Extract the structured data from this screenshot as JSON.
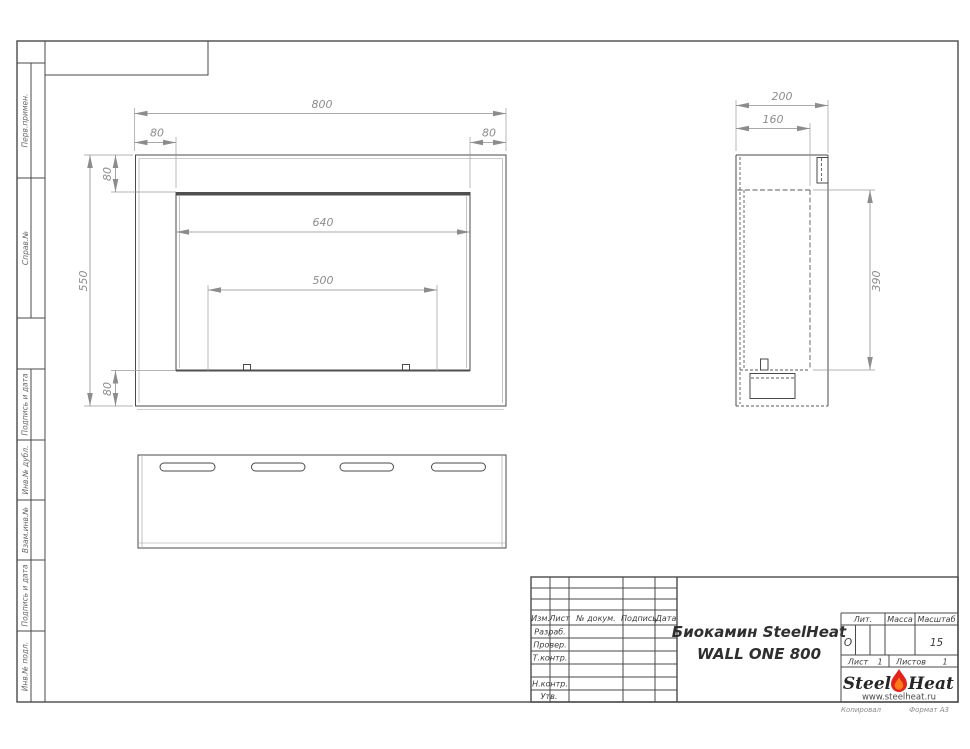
{
  "sidebar": {
    "perv_primen": "Перв.примен.",
    "sprav_no": "Справ.№",
    "podpis_data_1": "Подпись и дата",
    "inv_dubl": "Инв.№ дубл.",
    "vzam_inv": "Взам.инв.№",
    "podpis_data_2": "Подпись и дата",
    "inv_podl": "Инв.№ подл."
  },
  "dims": {
    "front": {
      "width": "800",
      "margin_left": "80",
      "margin_right": "80",
      "margin_top": "80",
      "margin_bottom": "80",
      "height": "550",
      "opening_width": "640",
      "burner_width": "500"
    },
    "side": {
      "depth": "200",
      "inner_depth": "160",
      "opening_height": "390"
    }
  },
  "title_block": {
    "cols": {
      "izm": "Изм.",
      "list": "Лист",
      "doc": "№ докум.",
      "sign": "Подпись",
      "date": "Дата"
    },
    "rows": {
      "razrab": "Разраб.",
      "prover": "Провер.",
      "tkontr": "Т.контр.",
      "nkontr": "Н.контр.",
      "utv": "Утв."
    },
    "title1": "Биокамин SteelHeat",
    "title2": "WALL ONE 800",
    "lit": {
      "label": "Лит.",
      "value": "О"
    },
    "mass": {
      "label": "Масса",
      "value": ""
    },
    "scale": {
      "label": "Масштаб",
      "value": "15"
    },
    "sheet": {
      "label": "Лист",
      "value": "1"
    },
    "sheets": {
      "label": "Листов",
      "value": "1"
    },
    "logo": {
      "steel": "Steel",
      "heat": "Heat",
      "site": "www.steelheat.ru"
    },
    "colors": {
      "flame_outer": "#e2241b",
      "flame_inner": "#ff7a1a",
      "line": "#4a4a4a"
    }
  },
  "footer": {
    "copy": "Копировал",
    "format": "Формат А3"
  }
}
